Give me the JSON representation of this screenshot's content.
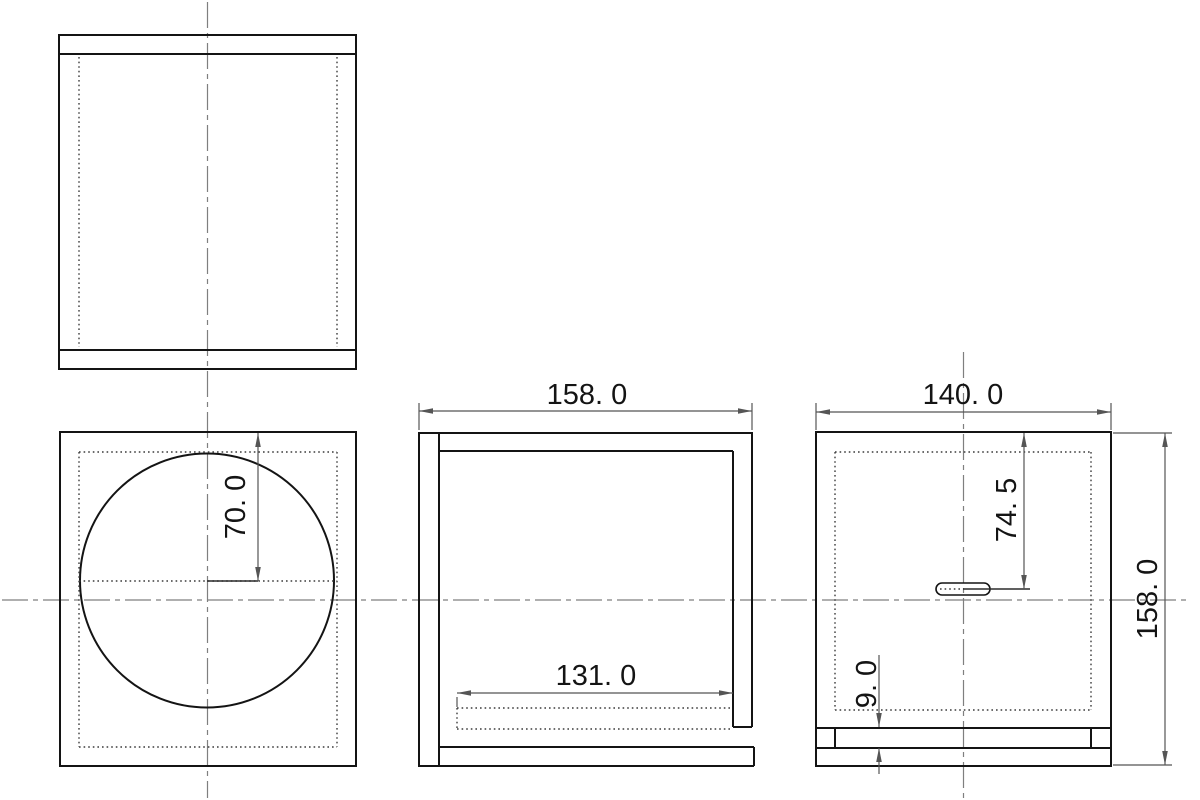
{
  "drawing": {
    "dimensions": {
      "front_driver_center_offset": "70. 0",
      "side_outer_width": "158. 0",
      "side_port_board_length": "131. 0",
      "rear_outer_width": "140. 0",
      "rear_terminal_hole_offset": "74. 5",
      "rear_port_slot_height": "9. 0",
      "rear_outer_height": "158. 0"
    },
    "colors": {
      "background": "#ffffff",
      "object_line": "#141414",
      "hidden_line": "#3c3c3c",
      "center_line": "#7f7f7f",
      "dimension_line": "#555555",
      "text": "#141414"
    }
  }
}
